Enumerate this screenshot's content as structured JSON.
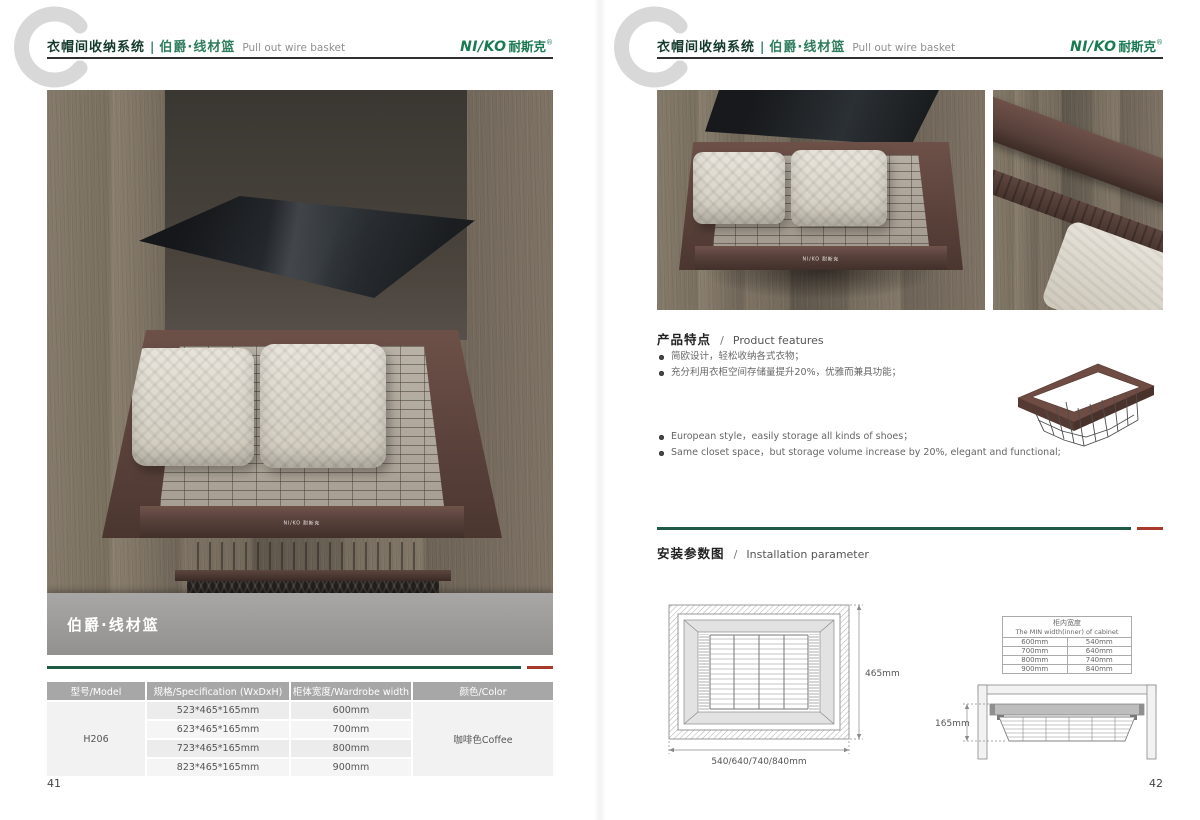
{
  "colors": {
    "brand_green": "#1a7a52",
    "title_dark_green": "#143a2d",
    "accent_line_green": "#1f5a44",
    "accent_line_red": "#a83a2c",
    "table_header_gray": "#a7a7a7",
    "basket_coffee": "#5a423b"
  },
  "brand": {
    "logo_en": "NI/KO",
    "logo_cn": "耐斯克",
    "reg_mark": "®",
    "logo_full": "NI/KO 耐斯克"
  },
  "header": {
    "system_cn": "衣帽间收纳系统",
    "divider": "|",
    "product_cn": "伯爵·线材篮",
    "product_en": "Pull out wire basket"
  },
  "left_page": {
    "page_number": "41",
    "photo_caption": "伯爵·线材篮",
    "spec_table": {
      "headers": [
        "型号/Model",
        "规格/Specification (WxDxH)",
        "柜体宽度/Wardrobe width",
        "颜色/Color"
      ],
      "model": "H206",
      "color": "咖啡色Coffee",
      "rows": [
        {
          "spec": "523*465*165mm",
          "width": "600mm"
        },
        {
          "spec": "623*465*165mm",
          "width": "700mm"
        },
        {
          "spec": "723*465*165mm",
          "width": "800mm"
        },
        {
          "spec": "823*465*165mm",
          "width": "900mm"
        }
      ]
    }
  },
  "right_page": {
    "page_number": "42",
    "features": {
      "heading_cn": "产品特点",
      "heading_sep": "/",
      "heading_en": "Product features",
      "bullets_cn": [
        "简欧设计，轻松收纳各式衣物；",
        "充分利用衣柜空间存储量提升20%，优雅而兼具功能；"
      ],
      "bullets_en": [
        "European style，easily storage all kinds of shoes；",
        "Same closet space，but storage volume increase by 20%, elegant and functional;"
      ]
    },
    "installation": {
      "heading_cn": "安装参数图",
      "heading_sep": "/",
      "heading_en": "Installation parameter",
      "top_view": {
        "depth_label": "465mm",
        "width_label": "540/640/740/840mm"
      },
      "side_view": {
        "height_label": "165mm"
      },
      "width_table": {
        "title_cn": "柜内宽度",
        "title_en": "The MIN width(inner) of cabinet",
        "rows": [
          [
            "600mm",
            "540mm"
          ],
          [
            "700mm",
            "640mm"
          ],
          [
            "800mm",
            "740mm"
          ],
          [
            "900mm",
            "840mm"
          ]
        ]
      }
    }
  }
}
